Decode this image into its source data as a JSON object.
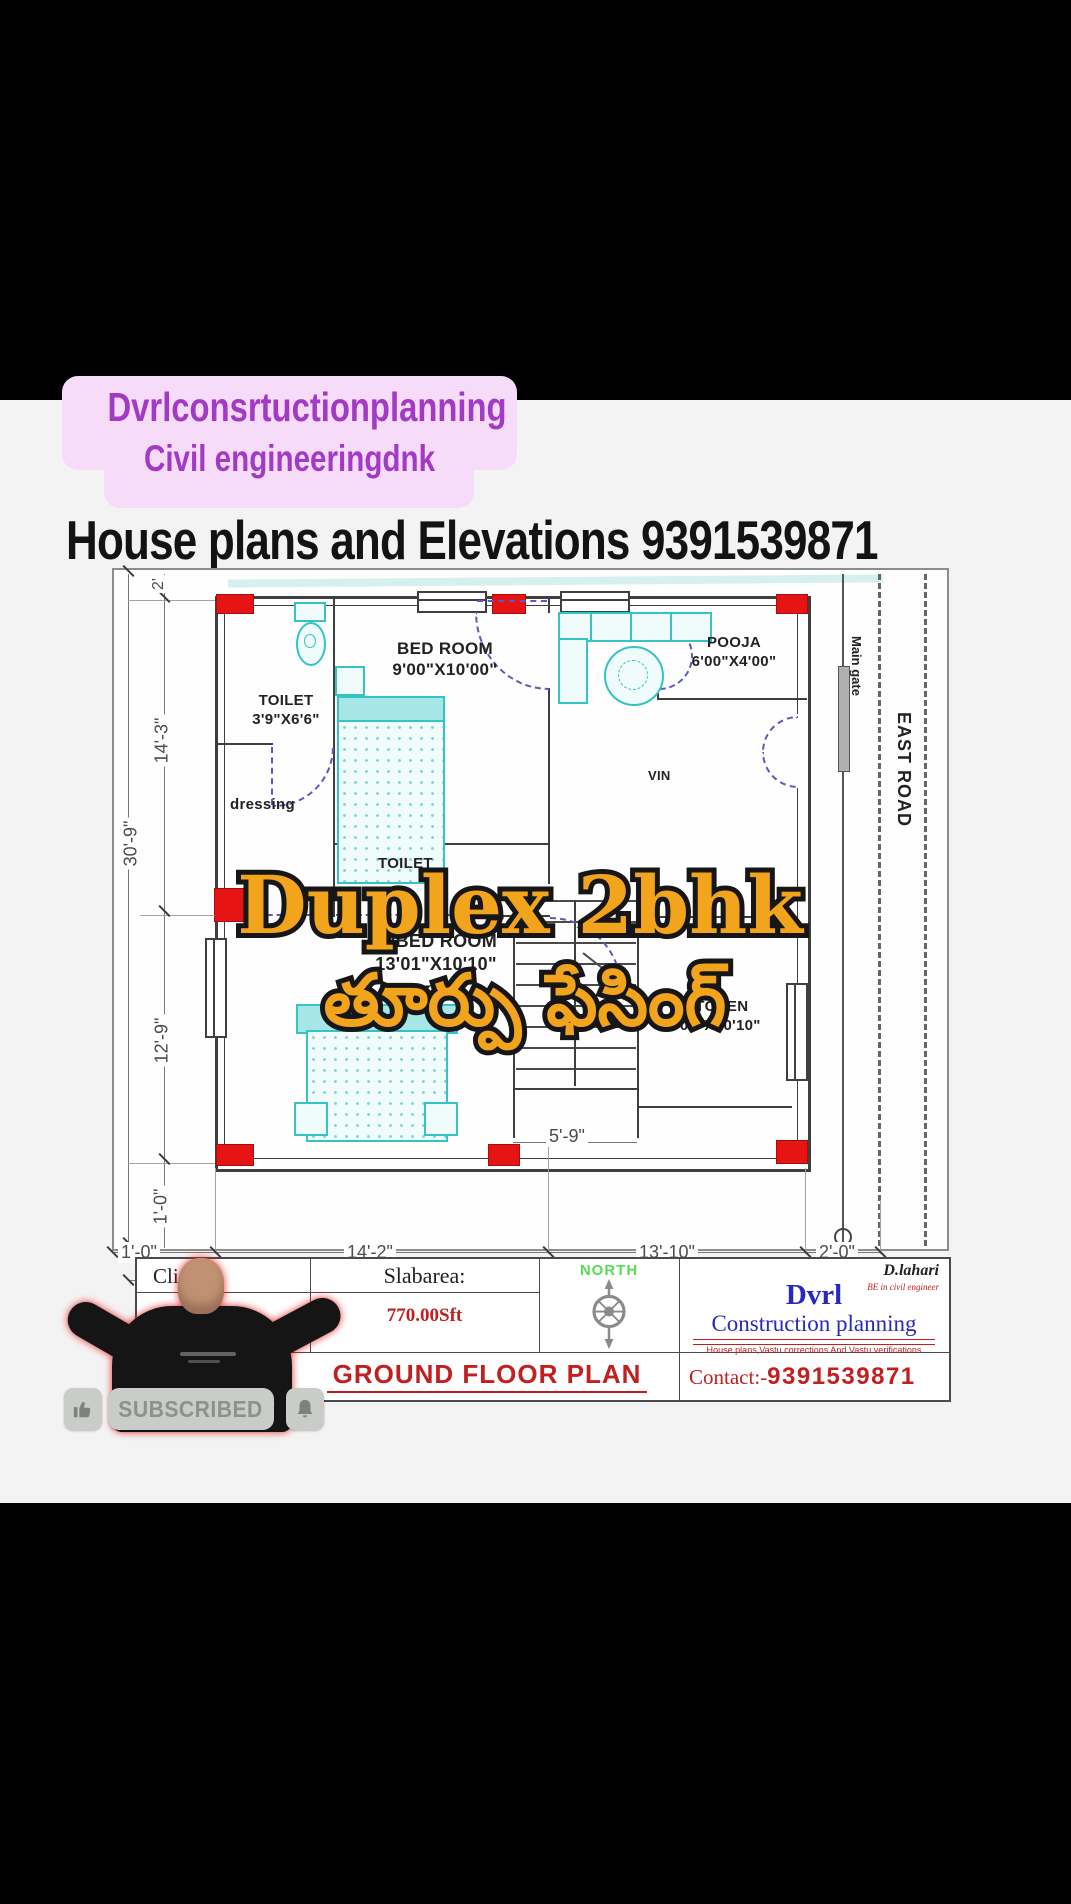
{
  "banner": {
    "line1": "Dvrlconsrtuctionplanning",
    "line2": "Civil engineeringdnk"
  },
  "heading": "House plans and Elevations 9391539871",
  "overlay": {
    "title": "Duplex 2bhk",
    "subtitle": "తూర్పు ఫేసింగ్"
  },
  "plan": {
    "rooms": {
      "toilet1": {
        "name": "TOILET",
        "size": "3'9\"X6'6\""
      },
      "bedroom": {
        "name": "BED ROOM",
        "size": "9'00\"X10'00\""
      },
      "pooja": {
        "name": "POOJA",
        "size": "6'00\"X4'00\""
      },
      "master": {
        "name": "M/BED ROOM",
        "size": "13'01\"X10'10\""
      },
      "kitchen": {
        "name": "KITCHEN",
        "size": "7'00\"X10'10\""
      }
    },
    "labels": {
      "dressing": "dressing",
      "toilet2": "TOILET",
      "living_fragment": "VIN",
      "main_gate": "Main gate",
      "east_road": "EAST ROAD"
    },
    "dims": {
      "left_total": "30'-9\"",
      "left": [
        "2'",
        "14'-3\"",
        "12'-9\"",
        "1'-0\""
      ],
      "bottom": [
        "1'-0\"",
        "14'-2\"",
        "13'-10\"",
        "2'-0\""
      ],
      "bottom_total": "31'-0\"",
      "stair_width": "5'-9\""
    }
  },
  "titleblock": {
    "client_label": "Client  :",
    "slab_label": "Slabarea:",
    "slab_value": "770.00Sft",
    "north_label": "NORTH",
    "plan_title": "GROUND FLOOR PLAN",
    "designer": "D.lahari",
    "designer_sub": "BE in civil engineer",
    "firm_name": "Dvrl",
    "firm_line2": "Construction planning",
    "firm_tagline": "House plans,Vastu corrections And Vastu verifications",
    "contact_label": "Contact:-",
    "contact_number": "9391539871"
  },
  "subscribe": {
    "label": "SUBSCRIBED"
  },
  "icons": {
    "thumb": "thumbs-up-icon",
    "bell": "bell-icon",
    "compass": "compass-rose"
  },
  "colors": {
    "overlay_orange": "#f2a41c",
    "plan_red": "#e71414",
    "cad_cyan": "#35c3c3",
    "door_purple": "#5b5bbf",
    "title_red": "#c22020",
    "firm_blue": "#2828bc",
    "north_green": "#55dd55",
    "banner_purple": "#a23ac6",
    "banner_bg": "#f6dcf8"
  }
}
